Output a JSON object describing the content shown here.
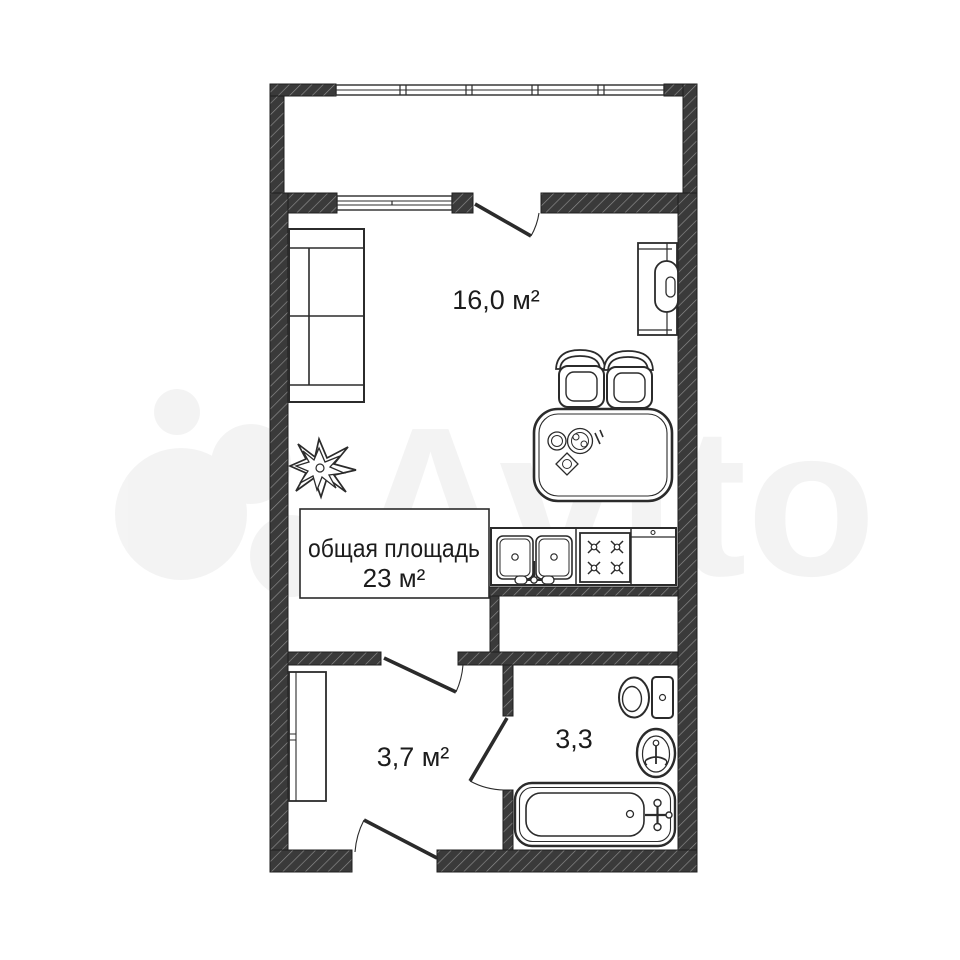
{
  "watermark": {
    "brand_text": "Avito"
  },
  "labels": {
    "main_room_area": "16,0 м²",
    "total_area_line1": "общая площадь",
    "total_area_line2": "23 м²",
    "hallway_area": "3,7 м²",
    "bathroom_area": "3,3"
  },
  "colors": {
    "background": "#ffffff",
    "wall_fill": "#3a3a3a",
    "wall_hatch": "#8d8d8d",
    "line": "#2b2b2b",
    "watermark_ink": "#000000"
  }
}
